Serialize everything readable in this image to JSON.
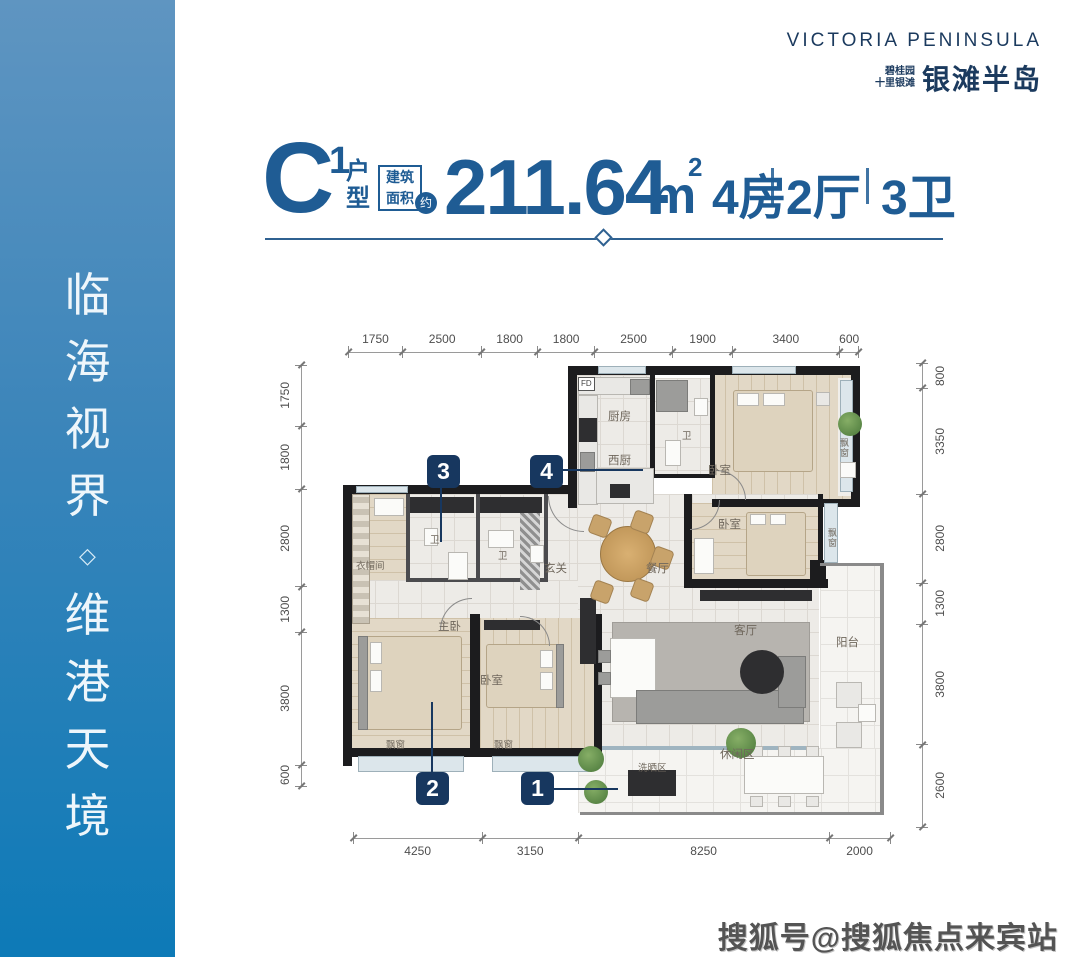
{
  "sidebar": {
    "chars": [
      "临",
      "海",
      "视",
      "界",
      "◇",
      "维",
      "港",
      "天",
      "境"
    ]
  },
  "logo": {
    "english": "VICTORIA PENINSULA",
    "brand_small_line1": "碧桂园",
    "brand_small_line2": "十里银滩",
    "brand_large": "银滩半岛"
  },
  "title": {
    "unit": "C",
    "unit_sup": "1",
    "unit_type_line1": "户",
    "unit_type_line2": "型",
    "area_box_line1": "建筑",
    "area_box_line2": "面积",
    "area_approx": "约",
    "area_value": "211.64",
    "area_unit": "m",
    "area_unit_sup": "2",
    "rooms": "4房",
    "halls": "2厅",
    "baths": "3卫"
  },
  "floorplan": {
    "dimensions": {
      "top": [
        "1750",
        "2500",
        "1800",
        "1800",
        "2500",
        "1900",
        "3400",
        "600"
      ],
      "left": [
        "1750",
        "1800",
        "2800",
        "1300",
        "3800",
        "600"
      ],
      "right": [
        "800",
        "3350",
        "2800",
        "1300",
        "3800",
        "2600"
      ],
      "bottom": [
        "4250",
        "3150",
        "8250",
        "2000"
      ]
    },
    "rooms": [
      {
        "id": "fd",
        "label": "FD"
      },
      {
        "id": "kitchen",
        "label": "厨房"
      },
      {
        "id": "west-kitchen",
        "label": "西厨"
      },
      {
        "id": "bath-top",
        "label": "卫"
      },
      {
        "id": "bedroom-1",
        "label": "卧室"
      },
      {
        "id": "bay-1",
        "label": "飘窗"
      },
      {
        "id": "bedroom-2",
        "label": "卧室"
      },
      {
        "id": "bay-2",
        "label": "飘窗"
      },
      {
        "id": "closet",
        "label": "衣帽间"
      },
      {
        "id": "bath-3",
        "label": "卫"
      },
      {
        "id": "bath-2",
        "label": "卫"
      },
      {
        "id": "foyer",
        "label": "玄关"
      },
      {
        "id": "dining",
        "label": "餐厅"
      },
      {
        "id": "living",
        "label": "客厅"
      },
      {
        "id": "master",
        "label": "主卧"
      },
      {
        "id": "bay-master",
        "label": "飘窗"
      },
      {
        "id": "bedroom-3",
        "label": "卧室"
      },
      {
        "id": "bay-3",
        "label": "飘窗"
      },
      {
        "id": "balcony",
        "label": "阳台"
      },
      {
        "id": "leisure",
        "label": "休闲区"
      },
      {
        "id": "laundry",
        "label": "洗晒区"
      }
    ],
    "markers": [
      {
        "id": "marker-1",
        "num": "1"
      },
      {
        "id": "marker-2",
        "num": "2"
      },
      {
        "id": "marker-3",
        "num": "3"
      },
      {
        "id": "marker-4",
        "num": "4"
      }
    ]
  },
  "watermark": {
    "text": "搜狐号@搜狐焦点来宾站"
  },
  "colors": {
    "accent": "#1f5c94",
    "marker_bg": "#17375f",
    "logo": "#1b3a5e",
    "wall": "#1c1c1e",
    "sidebar_top": "#5f95c1",
    "sidebar_bottom": "#0d7ab7"
  }
}
